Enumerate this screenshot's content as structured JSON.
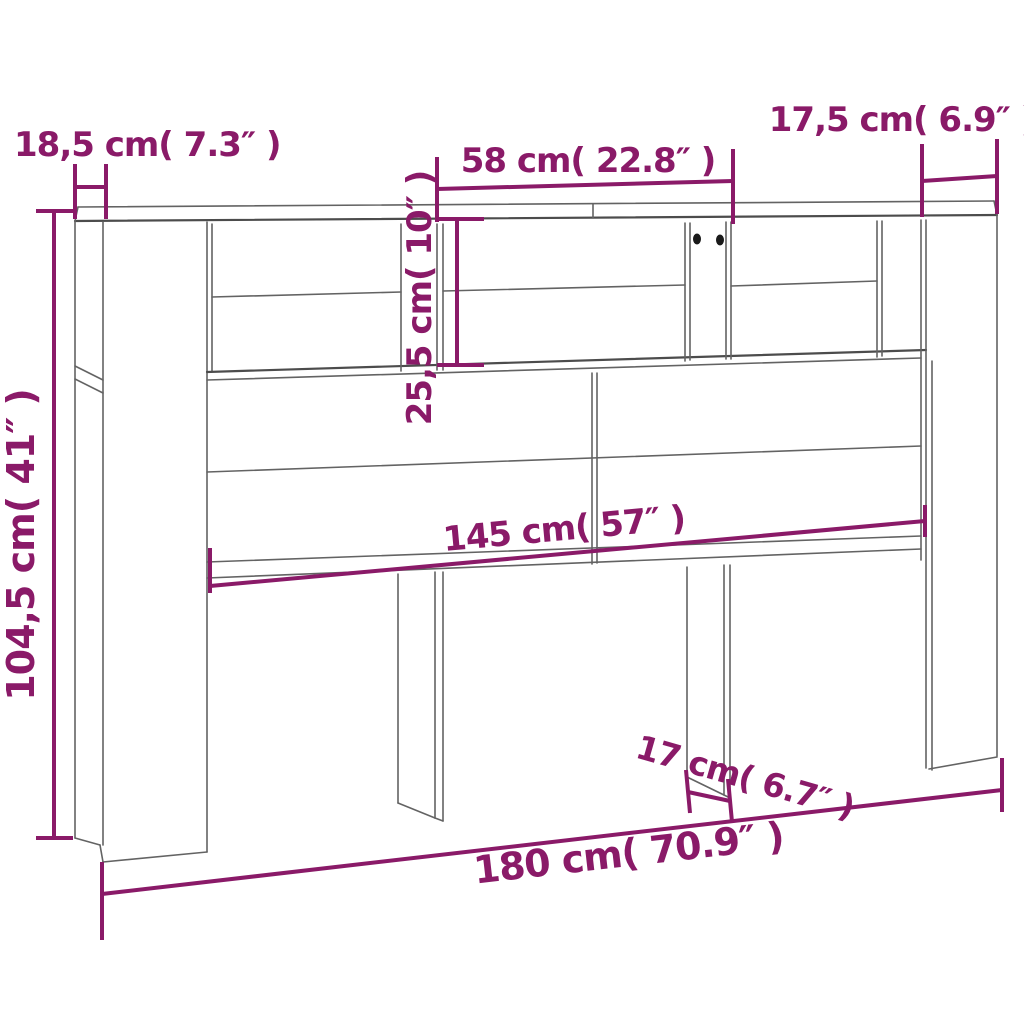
{
  "diagram": {
    "colors": {
      "dimension_accent": "#8a1a68",
      "outline": "#636363",
      "background": "#ffffff",
      "screw_hole": "#1a1a1a"
    },
    "labels": {
      "top_left_depth": "18,5 cm( 7.3″ )",
      "shelf_opening_width": "58 cm( 22.8″ )",
      "top_right_depth": "17,5 cm( 6.9″ )",
      "shelf_opening_height": "25,5 cm( 10″ )",
      "side_height": "104,5 cm( 41″ )",
      "inner_width": "145 cm( 57″ )",
      "leg_depth": "17 cm( 6.7″ )",
      "overall_width": "180 cm( 70.9″ )"
    }
  }
}
